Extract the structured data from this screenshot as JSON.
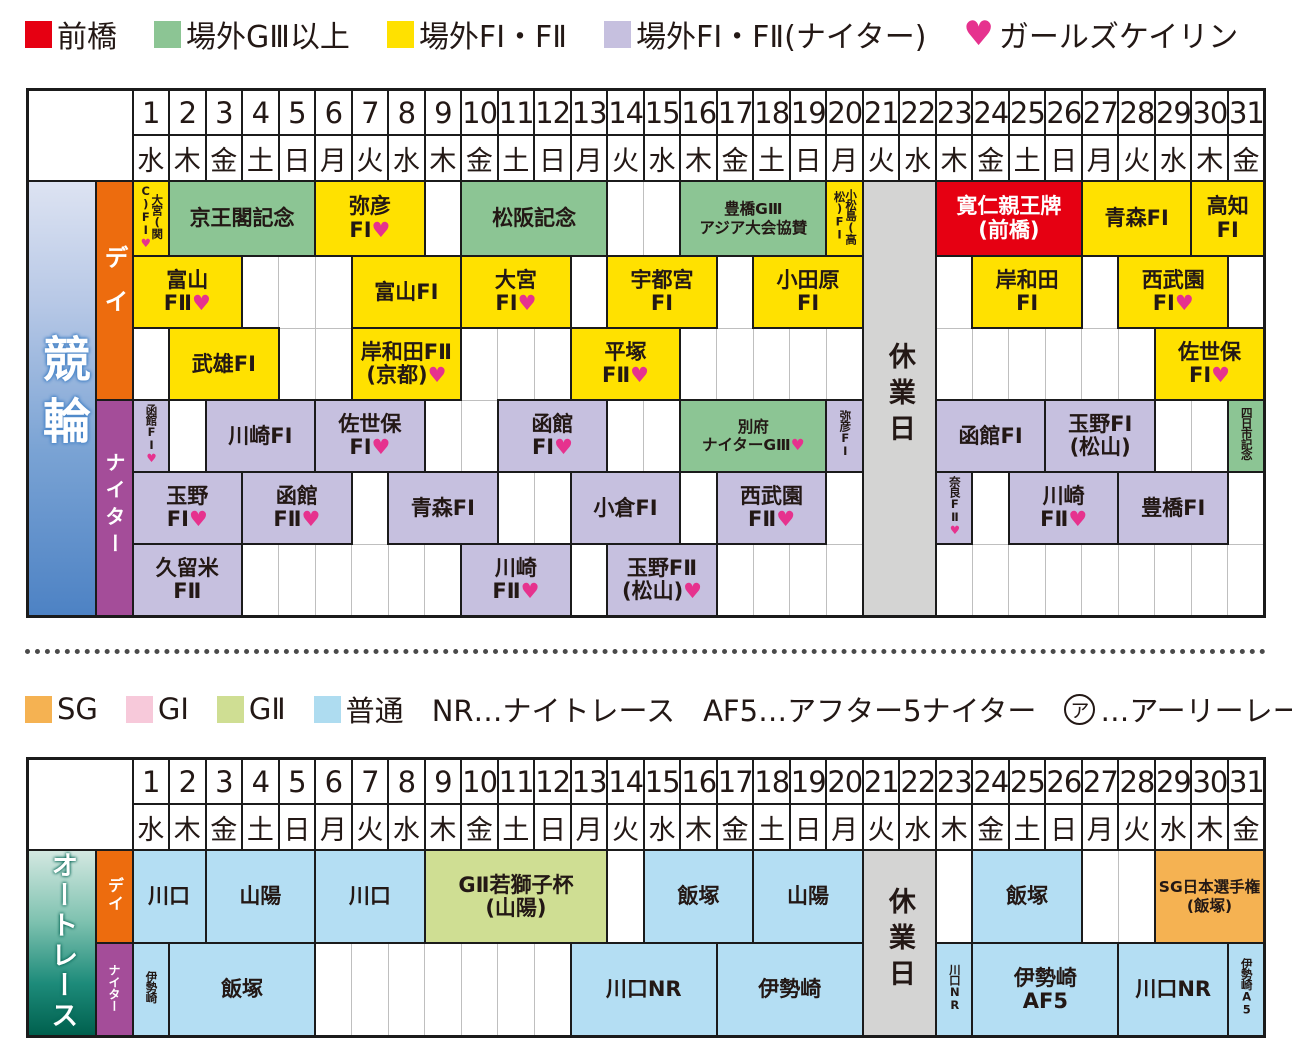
{
  "palette": {
    "maebashi_red": "#e60012",
    "gaisai_g3_green": "#8cc594",
    "gaisai_f_yellow": "#ffe100",
    "gaisai_night_lavender": "#c6c0df",
    "girls_pink": "#e6328e",
    "saturday_blue": "#56b7e6",
    "holiday_orange": "#ef926b",
    "closed_gray": "#d4d4d3",
    "sg_orange": "#f5b252",
    "g1_pink": "#f7c9da",
    "g2_green": "#cfde93",
    "futsu_blue": "#b4def3",
    "day_label_orange": "#ed6c0e",
    "night_label_purple": "#a44d99"
  },
  "legend_keirin": {
    "items": [
      {
        "color": "#e60012",
        "label": "前橋"
      },
      {
        "color": "#8cc594",
        "label": "場外GⅢ以上"
      },
      {
        "color": "#ffe100",
        "label": "場外FI・FⅡ"
      },
      {
        "color": "#c6c0df",
        "label": "場外FI・FⅡ(ナイター)"
      },
      {
        "symbol": "♥",
        "label": "ガールズケイリン"
      }
    ]
  },
  "legend_auto": {
    "items": [
      {
        "color": "#f5b252",
        "label": "SG"
      },
      {
        "color": "#f7c9da",
        "label": "GI"
      },
      {
        "color": "#cfde93",
        "label": "GⅡ"
      },
      {
        "color": "#aedcf0",
        "label": "普通"
      },
      {
        "label": "NR…ナイトレース"
      },
      {
        "label": "AF5…アフター5ナイター"
      },
      {
        "circled": "ア",
        "label": "…アーリーレース"
      }
    ]
  },
  "header": {
    "month": "10月",
    "days": [
      {
        "n": 1,
        "w": "水",
        "t": ""
      },
      {
        "n": 2,
        "w": "木",
        "t": ""
      },
      {
        "n": 3,
        "w": "金",
        "t": ""
      },
      {
        "n": 4,
        "w": "土",
        "t": "sat"
      },
      {
        "n": 5,
        "w": "日",
        "t": "hol"
      },
      {
        "n": 6,
        "w": "月",
        "t": ""
      },
      {
        "n": 7,
        "w": "火",
        "t": ""
      },
      {
        "n": 8,
        "w": "水",
        "t": ""
      },
      {
        "n": 9,
        "w": "木",
        "t": ""
      },
      {
        "n": 10,
        "w": "金",
        "t": ""
      },
      {
        "n": 11,
        "w": "土",
        "t": "sat"
      },
      {
        "n": 12,
        "w": "日",
        "t": "hol"
      },
      {
        "n": 13,
        "w": "月",
        "t": "hol"
      },
      {
        "n": 14,
        "w": "火",
        "t": ""
      },
      {
        "n": 15,
        "w": "水",
        "t": ""
      },
      {
        "n": 16,
        "w": "木",
        "t": ""
      },
      {
        "n": 17,
        "w": "金",
        "t": ""
      },
      {
        "n": 18,
        "w": "土",
        "t": "sat"
      },
      {
        "n": 19,
        "w": "日",
        "t": "hol"
      },
      {
        "n": 20,
        "w": "月",
        "t": ""
      },
      {
        "n": 21,
        "w": "火",
        "t": ""
      },
      {
        "n": 22,
        "w": "水",
        "t": ""
      },
      {
        "n": 23,
        "w": "木",
        "t": ""
      },
      {
        "n": 24,
        "w": "金",
        "t": ""
      },
      {
        "n": 25,
        "w": "土",
        "t": "sat"
      },
      {
        "n": 26,
        "w": "日",
        "t": "hol"
      },
      {
        "n": 27,
        "w": "月",
        "t": ""
      },
      {
        "n": 28,
        "w": "火",
        "t": ""
      },
      {
        "n": 29,
        "w": "水",
        "t": ""
      },
      {
        "n": 30,
        "w": "木",
        "t": ""
      },
      {
        "n": 31,
        "w": "金",
        "t": ""
      }
    ]
  },
  "tables": [
    {
      "id": "keirin",
      "side_label": "競輪",
      "side_class": "side-keirin",
      "side_name": "keirin-side-label",
      "closed": {
        "label": "休業日",
        "start": 21,
        "end": 22
      },
      "sections": [
        {
          "label": "デイ",
          "cls": "sub-day",
          "rows": [
            [
              {
                "s": 1,
                "c": "y",
                "t": [
                  "大宮(関C)FI♥"
                ],
                "v": 1
              },
              {
                "s": 4,
                "c": "g",
                "t": [
                  "京王閣記念"
                ]
              },
              {
                "s": 3,
                "c": "y",
                "t": [
                  "弥彦",
                  "FI♥"
                ]
              },
              {
                "s": 1,
                "c": "w"
              },
              {
                "s": 4,
                "c": "g",
                "t": [
                  "松阪記念"
                ]
              },
              {
                "s": 1,
                "c": "w"
              },
              {
                "s": 1,
                "c": "w"
              },
              {
                "s": 4,
                "c": "g",
                "t": [
                  "豊橋GⅢ",
                  "アジア大会協賛"
                ],
                "sm": 1
              },
              {
                "s": 1,
                "c": "y",
                "t": [
                  "小松島(高松)FI"
                ],
                "v": 1
              },
              {
                "s": 4,
                "c": "r",
                "t": [
                  "寛仁親王牌",
                  "(前橋)"
                ]
              },
              {
                "s": 3,
                "c": "y",
                "t": [
                  "青森FI"
                ]
              },
              {
                "s": 2,
                "c": "y",
                "t": [
                  "高知",
                  "FI"
                ]
              }
            ],
            [
              {
                "s": 3,
                "c": "y",
                "t": [
                  "富山",
                  "FⅡ♥"
                ]
              },
              {
                "s": 1,
                "c": "w"
              },
              {
                "s": 1,
                "c": "w"
              },
              {
                "s": 1,
                "c": "w"
              },
              {
                "s": 3,
                "c": "y",
                "t": [
                  "富山FI"
                ]
              },
              {
                "s": 3,
                "c": "y",
                "t": [
                  "大宮",
                  "FI♥"
                ]
              },
              {
                "s": 1,
                "c": "w"
              },
              {
                "s": 3,
                "c": "y",
                "t": [
                  "宇都宮",
                  "FI"
                ]
              },
              {
                "s": 1,
                "c": "w"
              },
              {
                "s": 3,
                "c": "y",
                "t": [
                  "小田原",
                  "FI"
                ]
              },
              {
                "s": 1,
                "c": "w"
              },
              {
                "s": 3,
                "c": "y",
                "t": [
                  "岸和田",
                  "FI"
                ]
              },
              {
                "s": 1,
                "c": "w"
              },
              {
                "s": 3,
                "c": "y",
                "t": [
                  "西武園",
                  "FI♥"
                ]
              },
              {
                "s": 1,
                "c": "w"
              }
            ],
            [
              {
                "s": 1,
                "c": "w"
              },
              {
                "s": 3,
                "c": "y",
                "t": [
                  "武雄FI"
                ]
              },
              {
                "s": 1,
                "c": "w"
              },
              {
                "s": 1,
                "c": "w"
              },
              {
                "s": 3,
                "c": "y",
                "t": [
                  "岸和田FⅡ",
                  "(京都)♥"
                ]
              },
              {
                "s": 1,
                "c": "w"
              },
              {
                "s": 1,
                "c": "w"
              },
              {
                "s": 1,
                "c": "w"
              },
              {
                "s": 3,
                "c": "y",
                "t": [
                  "平塚",
                  "FⅡ♥"
                ]
              },
              {
                "s": 1,
                "c": "w"
              },
              {
                "s": 1,
                "c": "w"
              },
              {
                "s": 1,
                "c": "w"
              },
              {
                "s": 1,
                "c": "w"
              },
              {
                "s": 1,
                "c": "w"
              },
              {
                "s": 1,
                "c": "w"
              },
              {
                "s": 1,
                "c": "w"
              },
              {
                "s": 1,
                "c": "w"
              },
              {
                "s": 1,
                "c": "w"
              },
              {
                "s": 1,
                "c": "w"
              },
              {
                "s": 1,
                "c": "w"
              },
              {
                "s": 3,
                "c": "y",
                "t": [
                  "佐世保",
                  "FI♥"
                ]
              }
            ]
          ]
        },
        {
          "label": "ナイター",
          "cls": "sub-night",
          "rows": [
            [
              {
                "s": 1,
                "c": "l",
                "t": [
                  "函館FI♥"
                ],
                "v": 1
              },
              {
                "s": 1,
                "c": "w"
              },
              {
                "s": 3,
                "c": "l",
                "t": [
                  "川崎FI"
                ]
              },
              {
                "s": 3,
                "c": "l",
                "t": [
                  "佐世保",
                  "FI♥"
                ]
              },
              {
                "s": 1,
                "c": "w"
              },
              {
                "s": 1,
                "c": "w"
              },
              {
                "s": 3,
                "c": "l",
                "t": [
                  "函館",
                  "FI♥"
                ]
              },
              {
                "s": 1,
                "c": "w"
              },
              {
                "s": 1,
                "c": "w"
              },
              {
                "s": 4,
                "c": "g",
                "t": [
                  "別府",
                  "ナイターGⅢ♥"
                ],
                "sm": 1
              },
              {
                "s": 1,
                "c": "l",
                "t": [
                  "弥彦FI"
                ],
                "v": 1
              },
              {
                "s": 3,
                "c": "l",
                "t": [
                  "函館FI"
                ]
              },
              {
                "s": 3,
                "c": "l",
                "t": [
                  "玉野FI",
                  "(松山)"
                ]
              },
              {
                "s": 1,
                "c": "w"
              },
              {
                "s": 1,
                "c": "w"
              },
              {
                "s": 1,
                "c": "g",
                "t": [
                  "四日市記念"
                ],
                "v": 1
              }
            ],
            [
              {
                "s": 3,
                "c": "l",
                "t": [
                  "玉野",
                  "FI♥"
                ]
              },
              {
                "s": 3,
                "c": "l",
                "t": [
                  "函館",
                  "FⅡ♥"
                ]
              },
              {
                "s": 1,
                "c": "w"
              },
              {
                "s": 3,
                "c": "l",
                "t": [
                  "青森FI"
                ]
              },
              {
                "s": 1,
                "c": "w"
              },
              {
                "s": 1,
                "c": "w"
              },
              {
                "s": 3,
                "c": "l",
                "t": [
                  "小倉FI"
                ]
              },
              {
                "s": 1,
                "c": "w"
              },
              {
                "s": 3,
                "c": "l",
                "t": [
                  "西武園",
                  "FⅡ♥"
                ]
              },
              {
                "s": 1,
                "c": "w"
              },
              {
                "s": 1,
                "c": "l",
                "t": [
                  "奈良FⅡ♥"
                ],
                "v": 1
              },
              {
                "s": 1,
                "c": "w"
              },
              {
                "s": 3,
                "c": "l",
                "t": [
                  "川崎",
                  "FⅡ♥"
                ]
              },
              {
                "s": 3,
                "c": "l",
                "t": [
                  "豊橋FI"
                ]
              },
              {
                "s": 1,
                "c": "w"
              }
            ],
            [
              {
                "s": 3,
                "c": "l",
                "t": [
                  "久留米",
                  "FⅡ"
                ]
              },
              {
                "s": 1,
                "c": "w"
              },
              {
                "s": 1,
                "c": "w"
              },
              {
                "s": 1,
                "c": "w"
              },
              {
                "s": 1,
                "c": "w"
              },
              {
                "s": 1,
                "c": "w"
              },
              {
                "s": 1,
                "c": "w"
              },
              {
                "s": 3,
                "c": "l",
                "t": [
                  "川崎",
                  "FⅡ♥"
                ]
              },
              {
                "s": 1,
                "c": "w"
              },
              {
                "s": 3,
                "c": "l",
                "t": [
                  "玉野FⅡ",
                  "(松山)♥"
                ]
              },
              {
                "s": 1,
                "c": "w"
              },
              {
                "s": 1,
                "c": "w"
              },
              {
                "s": 1,
                "c": "w"
              },
              {
                "s": 1,
                "c": "w"
              },
              {
                "s": 1,
                "c": "w"
              },
              {
                "s": 1,
                "c": "w"
              },
              {
                "s": 1,
                "c": "w"
              },
              {
                "s": 1,
                "c": "w"
              },
              {
                "s": 1,
                "c": "w"
              },
              {
                "s": 1,
                "c": "w"
              },
              {
                "s": 1,
                "c": "w"
              },
              {
                "s": 1,
                "c": "w"
              },
              {
                "s": 1,
                "c": "w"
              }
            ]
          ]
        }
      ]
    },
    {
      "id": "autorace",
      "side_label": "オートレース",
      "side_class": "side-auto",
      "side_name": "autorace-side-label",
      "closed": {
        "label": "休業日",
        "start": 21,
        "end": 22
      },
      "sections": [
        {
          "label": "デイ",
          "cls": "sub-day",
          "rows": [
            [
              {
                "s": 2,
                "c": "b",
                "t": [
                  "川口"
                ]
              },
              {
                "s": 3,
                "c": "b",
                "t": [
                  "山陽"
                ]
              },
              {
                "s": 3,
                "c": "b",
                "t": [
                  "川口"
                ]
              },
              {
                "s": 5,
                "c": "lg",
                "t": [
                  "GⅡ若獅子杯",
                  "(山陽)"
                ]
              },
              {
                "s": 1,
                "c": "w"
              },
              {
                "s": 3,
                "c": "b",
                "t": [
                  "飯塚"
                ]
              },
              {
                "s": 3,
                "c": "b",
                "t": [
                  "山陽"
                ]
              },
              {
                "s": 1,
                "c": "w"
              },
              {
                "s": 3,
                "c": "b",
                "t": [
                  "飯塚"
                ]
              },
              {
                "s": 1,
                "c": "w"
              },
              {
                "s": 1,
                "c": "w"
              },
              {
                "s": 3,
                "c": "o",
                "t": [
                  "SG日本選手権",
                  "(飯塚)"
                ],
                "sm": 1
              }
            ]
          ]
        },
        {
          "label": "ナイター",
          "cls": "sub-night",
          "rows": [
            [
              {
                "s": 1,
                "c": "b",
                "t": [
                  "伊勢崎"
                ],
                "v": 1
              },
              {
                "s": 4,
                "c": "b",
                "t": [
                  "飯塚"
                ]
              },
              {
                "s": 1,
                "c": "w"
              },
              {
                "s": 1,
                "c": "w"
              },
              {
                "s": 1,
                "c": "w"
              },
              {
                "s": 1,
                "c": "w"
              },
              {
                "s": 1,
                "c": "w"
              },
              {
                "s": 1,
                "c": "w"
              },
              {
                "s": 1,
                "c": "w"
              },
              {
                "s": 4,
                "c": "b",
                "t": [
                  "川口NR"
                ]
              },
              {
                "s": 4,
                "c": "b",
                "t": [
                  "伊勢崎"
                ]
              },
              {
                "s": 1,
                "c": "b",
                "t": [
                  "川口NR"
                ],
                "v": 1
              },
              {
                "s": 4,
                "c": "b",
                "t": [
                  "伊勢崎",
                  "AF5"
                ]
              },
              {
                "s": 3,
                "c": "b",
                "t": [
                  "川口NR"
                ]
              },
              {
                "s": 1,
                "c": "b",
                "t": [
                  "伊勢崎A5"
                ],
                "v": 1
              }
            ]
          ]
        }
      ]
    }
  ]
}
